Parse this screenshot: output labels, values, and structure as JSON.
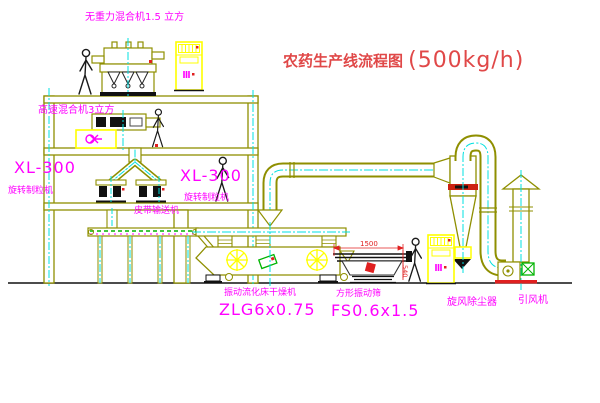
{
  "title": {
    "text": "农药生产线流程图",
    "capacity": "(500kg/h)"
  },
  "labels": {
    "gravity_mixer": "无重力混合机1.5 立方",
    "speed_mixer": "高速混合机3立方",
    "granulator_left_model": "XL-300",
    "granulator_left_name": "旋转制粒机",
    "granulator_right_model": "XL-300",
    "granulator_right_name": "旋转制粒机",
    "belt_conveyor": "皮带输送机",
    "dryer_name": "振动流化床干燥机",
    "dryer_model": "ZLG6x0.75",
    "screen_name": "方形振动筛",
    "screen_model": "FS0.6x1.5",
    "cyclone": "旋风除尘器",
    "fan": "引风机",
    "screen_dim_w": "1500",
    "screen_dim_h": "540"
  },
  "colors": {
    "line_olive": "#8f8f00",
    "centerline_cyan": "#00e0e0",
    "label_magenta": "#ff00ff",
    "title_red": "#e04848",
    "cabinet_yellow": "#ffff00",
    "accent_green": "#00b400",
    "accent_red": "#e02020",
    "machine_black": "#111111"
  }
}
